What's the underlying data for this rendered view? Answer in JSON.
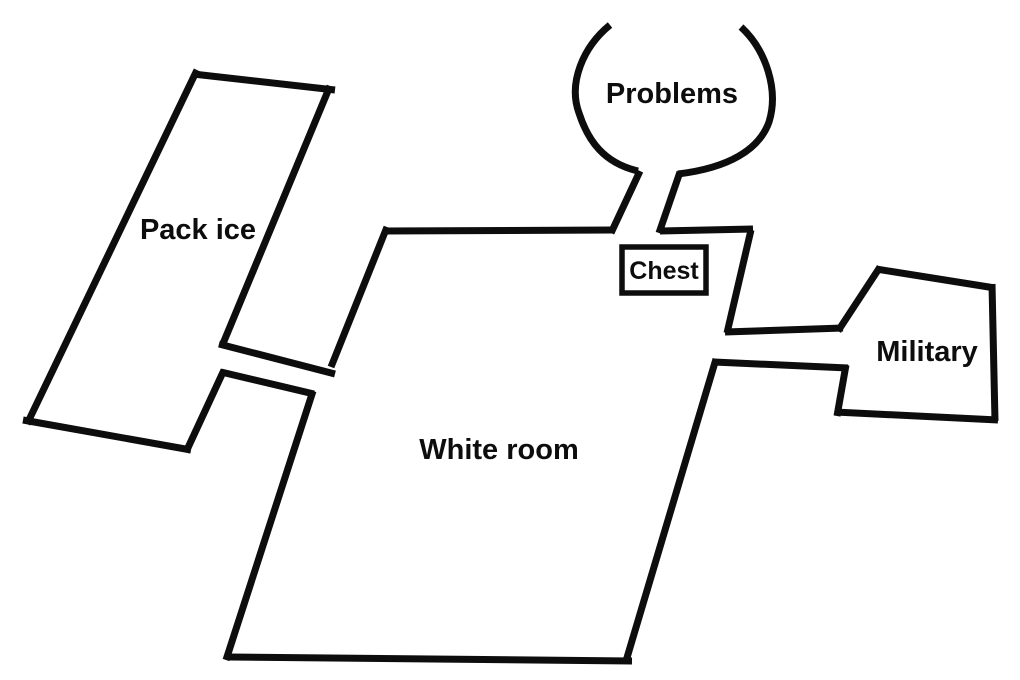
{
  "diagram": {
    "background_color": "#ffffff",
    "line_color": "#0d0d0d",
    "rooms": [
      {
        "id": "pack-ice",
        "label": "Pack ice"
      },
      {
        "id": "problems",
        "label": "Problems"
      },
      {
        "id": "white-room",
        "label": "White room"
      },
      {
        "id": "military",
        "label": "Military"
      }
    ],
    "objects": [
      {
        "id": "chest",
        "label": "Chest",
        "located_in": "white-room"
      }
    ],
    "connections": [
      {
        "from": "pack-ice",
        "to": "white-room"
      },
      {
        "from": "problems",
        "to": "white-room"
      },
      {
        "from": "military",
        "to": "white-room"
      }
    ]
  }
}
